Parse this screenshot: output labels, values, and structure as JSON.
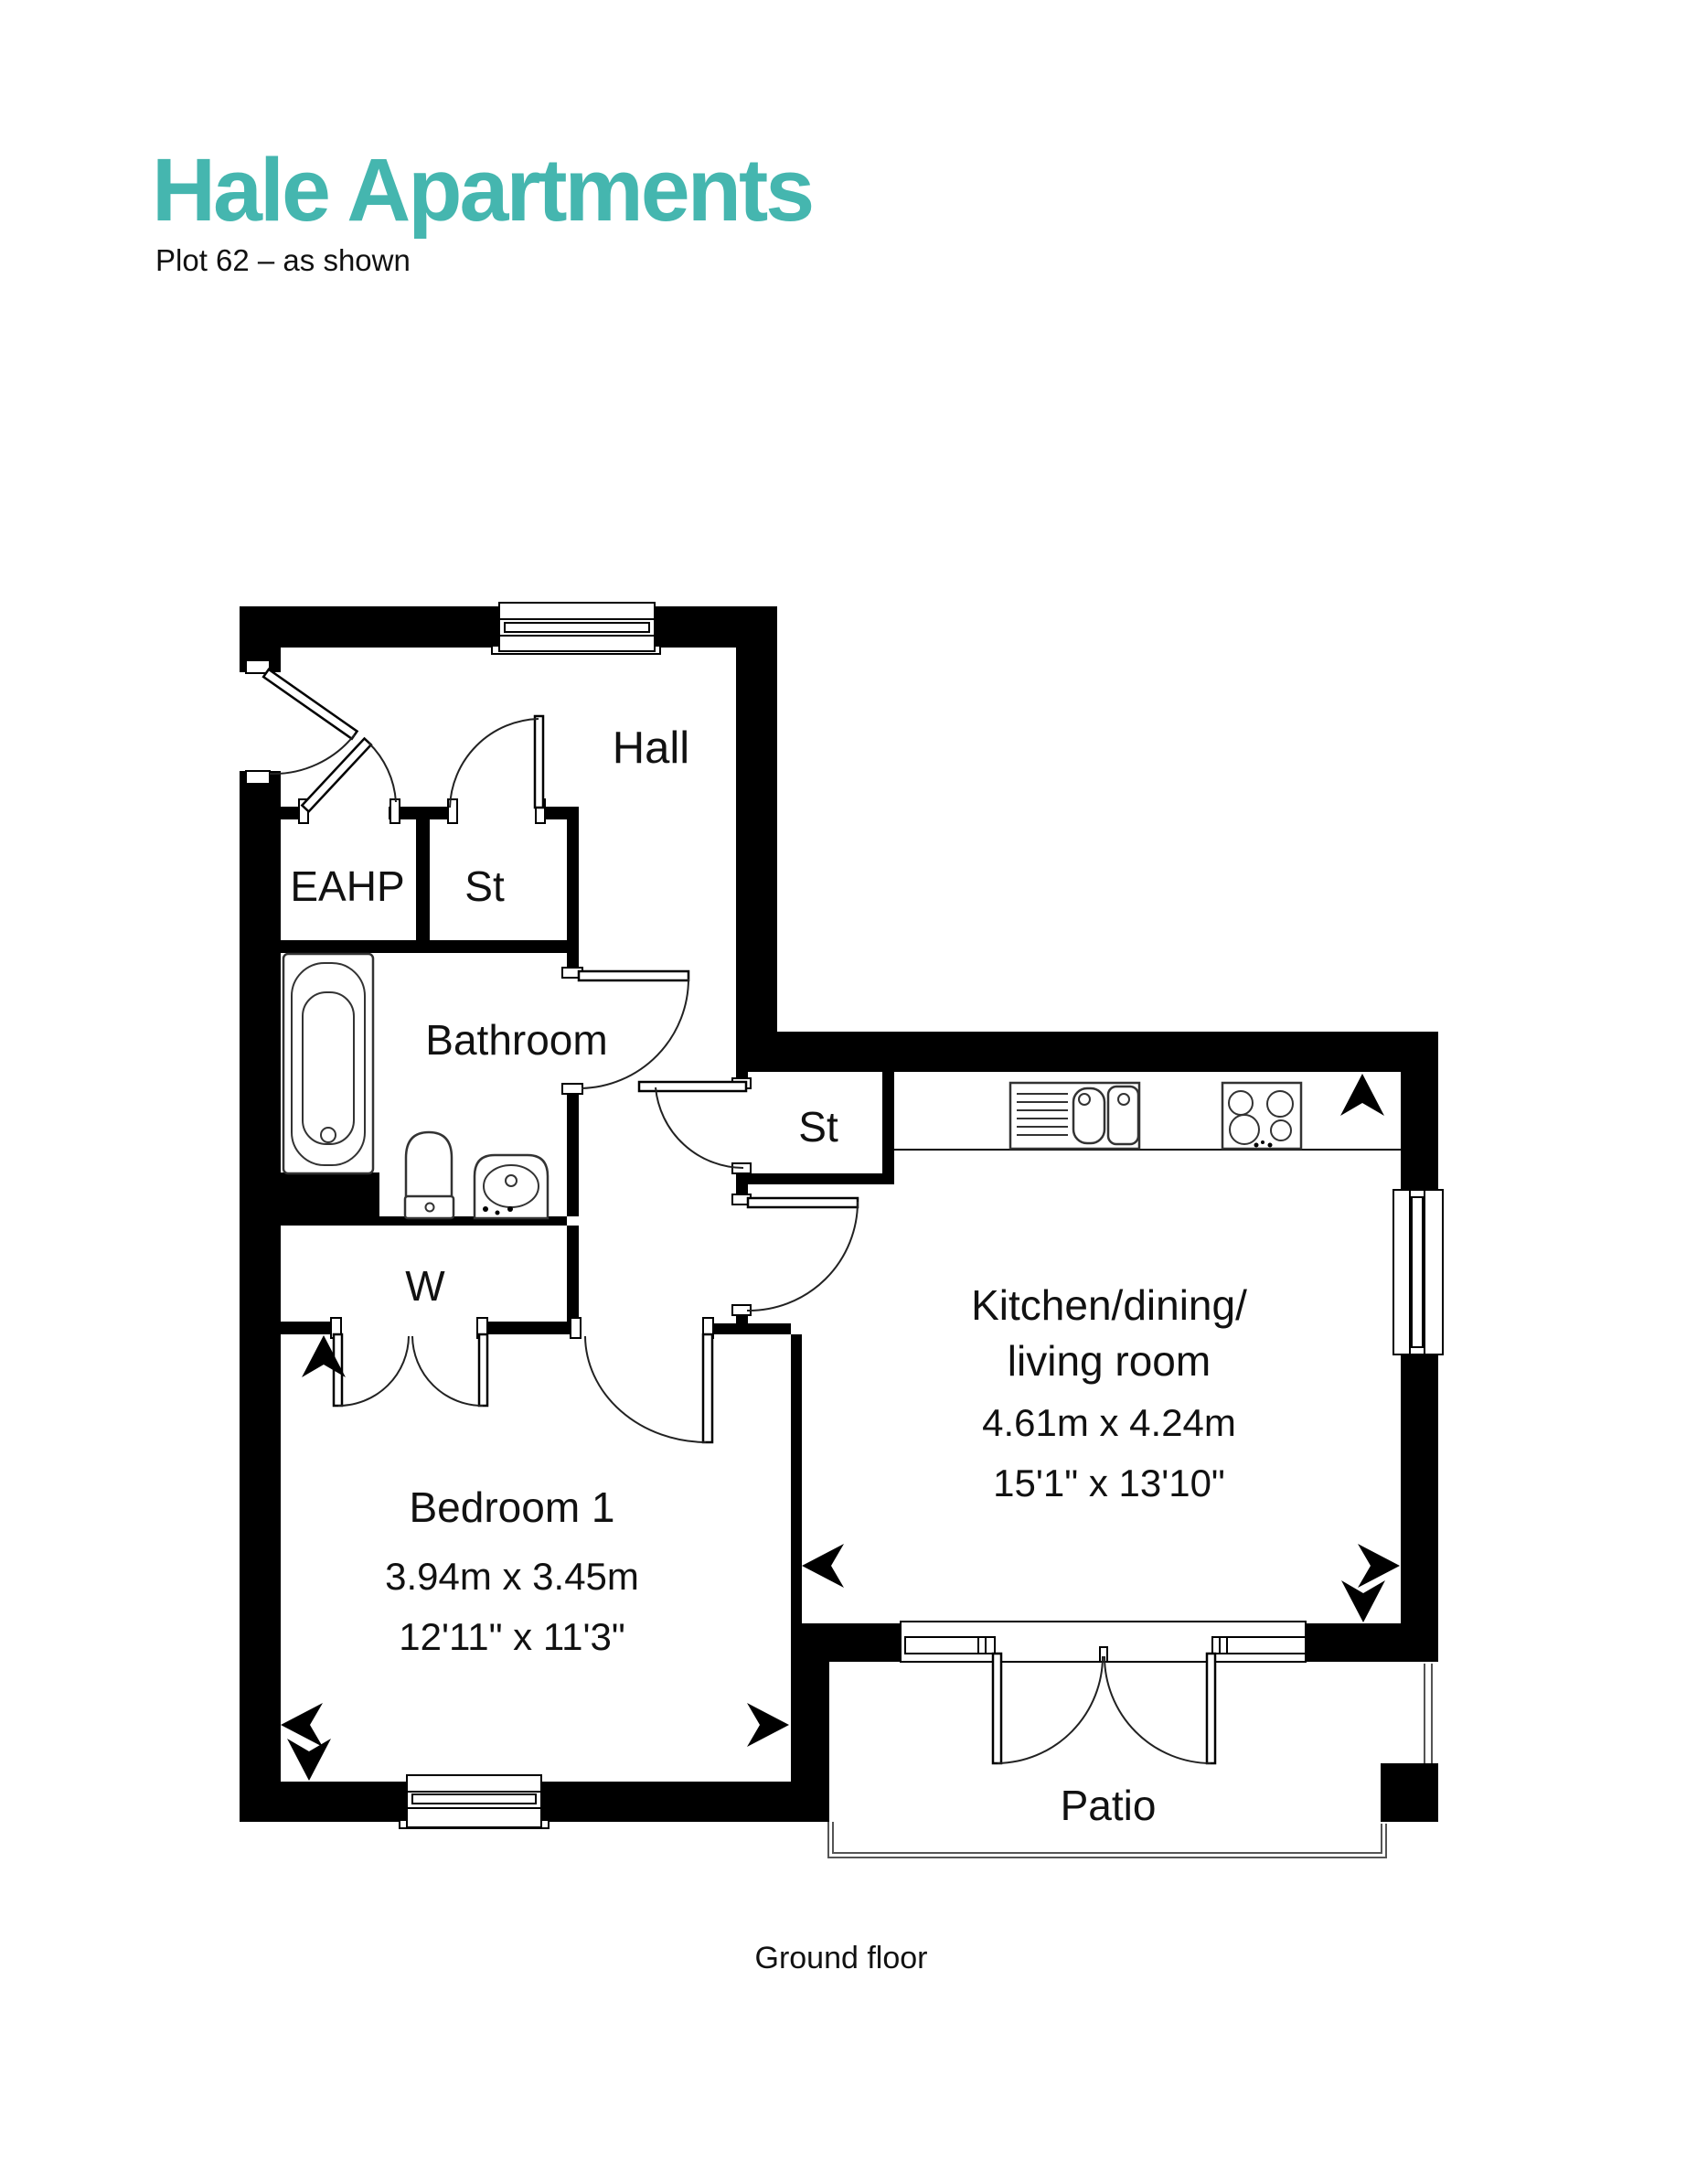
{
  "page": {
    "title": "Hale Apartments",
    "subtitle": "Plot 62 – as shown",
    "floor_label": "Ground floor",
    "accent_color": "#45b6af"
  },
  "rooms": {
    "hall": {
      "label": "Hall"
    },
    "eahp": {
      "label": "EAHP"
    },
    "store1": {
      "label": "St"
    },
    "bathroom": {
      "label": "Bathroom"
    },
    "store2": {
      "label": "St"
    },
    "wardrobe": {
      "label": "W"
    },
    "kitchen": {
      "label_line1": "Kitchen/dining/",
      "label_line2": "living room",
      "dim_metric": "4.61m x 4.24m",
      "dim_imperial": "15'1\" x 13'10\""
    },
    "bedroom1": {
      "label": "Bedroom 1",
      "dim_metric": "3.94m x 3.45m",
      "dim_imperial": "12'11\" x 11'3\""
    },
    "patio": {
      "label": "Patio"
    }
  }
}
